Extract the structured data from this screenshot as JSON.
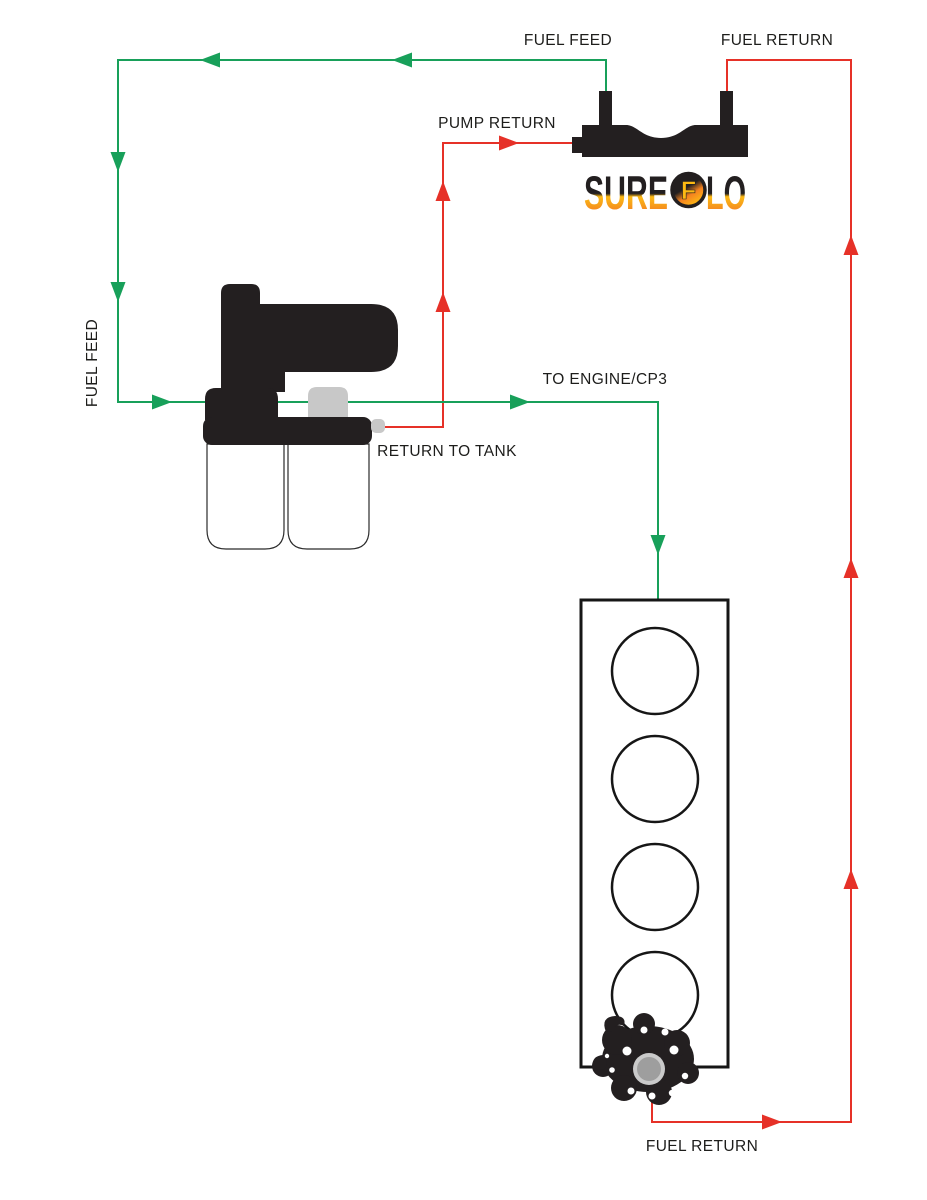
{
  "title": "Fuel system flow diagram",
  "labels": {
    "fuel_feed_top": "FUEL FEED",
    "fuel_return_top": "FUEL RETURN",
    "pump_return": "PUMP RETURN",
    "fuel_feed_left": "FUEL FEED",
    "to_engine_cp3": "TO ENGINE/CP3",
    "return_to_tank": "RETURN TO TANK",
    "fuel_return_bottom": "FUEL RETURN"
  },
  "logo": {
    "part1": "SURE",
    "circle_letter": "F",
    "part2": "LO"
  },
  "colors": {
    "feed_line": "#18a05a",
    "return_line": "#e63128",
    "component_black": "#231f20",
    "fitting_gray": "#c8c8c8",
    "label_text": "#1d1d1b",
    "logo_orange": "#f58220",
    "logo_yellow": "#fdb913"
  },
  "components": {
    "tank_module_icon": "fuel-tank-sump-module-icon",
    "pump_assembly_icon": "lift-pump-dual-filter-icon",
    "engine_icon": "inline-4-engine-block-icon",
    "injection_pump_icon": "cp3-injection-pump-icon"
  }
}
